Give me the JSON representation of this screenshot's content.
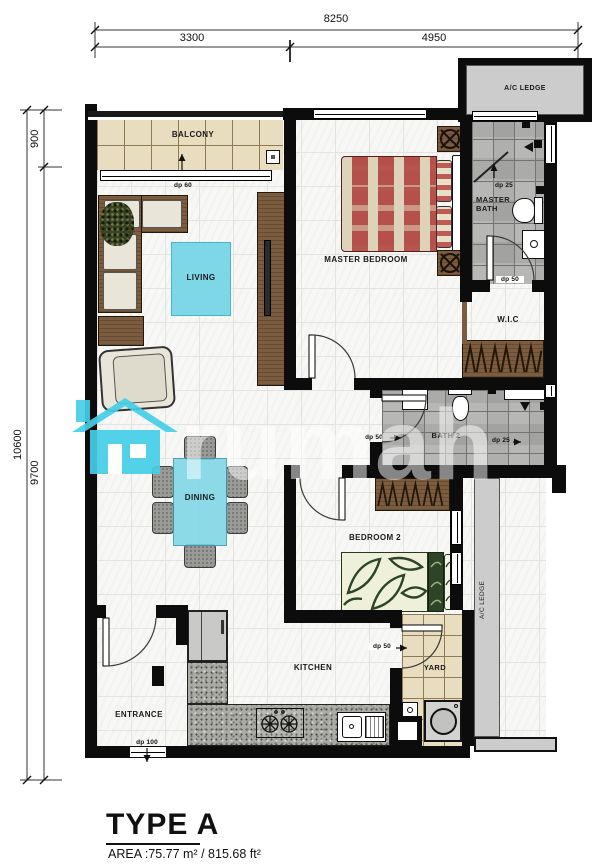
{
  "meta": {
    "type_label": "TYPE A",
    "area_label": "AREA :75.77 m² / 815.68 ft²"
  },
  "dimensions": {
    "top_total": "8250",
    "top_left": "3300",
    "top_right": "4950",
    "left_total": "10600",
    "left_top": "900",
    "left_main": "9700"
  },
  "rooms": {
    "balcony": "BALCONY",
    "living": "LIVING",
    "master_bedroom": "MASTER BEDROOM",
    "master_bath": "MASTER BATH",
    "wic": "W.I.C",
    "bath2": "BATH 2",
    "dining": "DINING",
    "bedroom2": "BEDROOM 2",
    "kitchen": "KITCHEN",
    "entrance": "ENTRANCE",
    "yard": "YARD",
    "ac_ledge_top": "A/C LEDGE",
    "ac_ledge_side": "A/C LEDGE"
  },
  "door_labels": {
    "balcony": "dp 60",
    "master_bath_shower": "dp 25",
    "master_bath_door": "dp 50",
    "bath2_door": "dp 50",
    "bath2_shower": "dp 25",
    "yard_door": "dp 50",
    "entrance": "dp 100"
  },
  "watermark": {
    "text": "rumah"
  },
  "colors": {
    "wall": "#0c0c0c",
    "accent_cyan": "#7ed7e6",
    "wood": "#7b5c3e",
    "bath_tile": "#a2a2a0",
    "balcony_tile": "#e9ddbf",
    "bed_red": "#b5504b",
    "leaf_green": "#2c4527",
    "ledge_gray": "#cccccc"
  }
}
